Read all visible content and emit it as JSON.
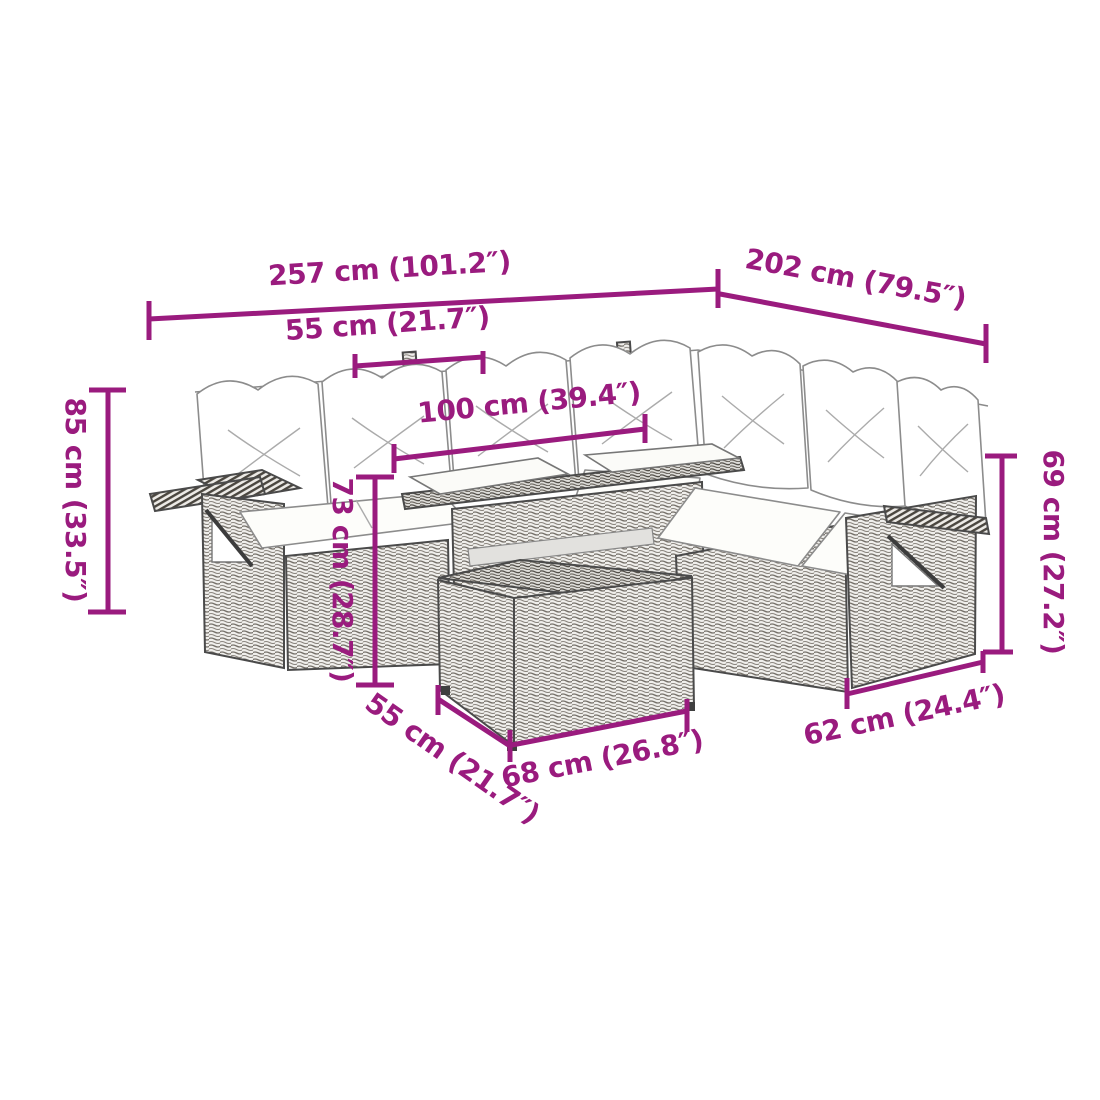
{
  "page": {
    "background": "#ffffff",
    "accent_color": "#9A1B7E",
    "line_art_color": "#4a4a4a"
  },
  "illustration": {
    "description": "L-shaped poly rattan garden lounge set sketch: back cushions, seat pads, glass-top table, front ottoman table and fold-down side trays on both end units"
  },
  "dimensions": {
    "overall_width": {
      "label": "257 cm (101.2″)"
    },
    "overall_depth": {
      "label": "202 cm (79.5″)"
    },
    "seat_width_top": {
      "label": "55 cm (21.7″)"
    },
    "table_length": {
      "label": "100 cm (39.4″)"
    },
    "back_height": {
      "label": "85 cm (33.5″)"
    },
    "table_height": {
      "label": "73 cm (28.7″)"
    },
    "arm_height": {
      "label": "69 cm (27.2″)"
    },
    "seat_depth_bottom": {
      "label": "55 cm (21.7″)"
    },
    "ottoman_width": {
      "label": "68 cm (26.8″)"
    },
    "end_width": {
      "label": "62 cm (24.4″)"
    }
  }
}
